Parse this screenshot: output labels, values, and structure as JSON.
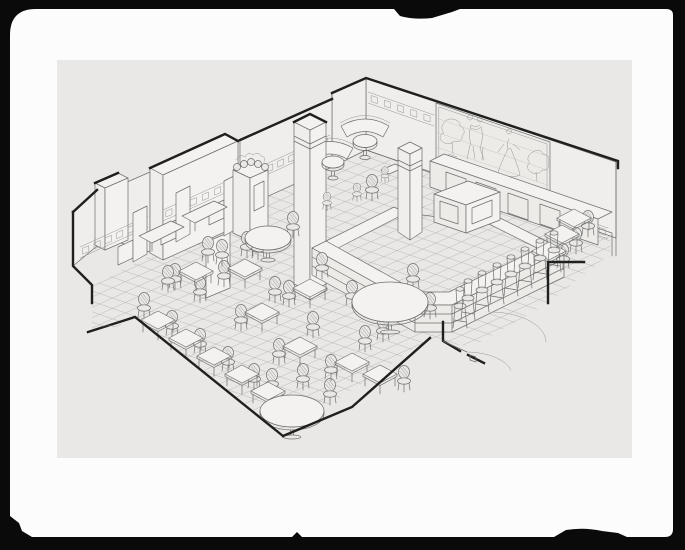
{
  "photo": {
    "frame_color": "#0a0a0a",
    "mat_color": "#fcfcfc",
    "paper_color": "#e9e8e6"
  },
  "colors": {
    "ink": "#6e6e6e",
    "ink_light": "#969593",
    "ink_heavy": "#1f1f1f",
    "fill_white": "#f3f2f0",
    "wall_fill": "#efeeec",
    "panel_fill": "#ecebe8",
    "grid": "#b4b3b0",
    "hatch": "#c6c5c2"
  },
  "drawing": {
    "scene_label": "axonometric cutaway line rendering of a restaurant dining room",
    "features": [
      "stepped-perimeter-walls",
      "ornamental-frieze-band",
      "figural-wall-mural",
      "wall-booths-with-tables",
      "curved-banquettes",
      "china-hutch-with-plates",
      "freestanding-square-column",
      "service-counter-with-pylon",
      "back-bar-cabinets",
      "bar-stool-row",
      "square-dining-tables",
      "bentwood-chairs",
      "tile-floor-grid",
      "door-swing-arcs"
    ],
    "mural_figures": [
      "foliage-left",
      "dancing-couple",
      "gowned-figure",
      "foliage-right"
    ]
  },
  "scene": {
    "grid": {
      "slope_r": 0.345,
      "b_r_min": 20,
      "b_r_max": 320,
      "slope_l": -0.459,
      "b_l_min": 308,
      "b_l_max": 600,
      "step": 10.4
    },
    "frieze_segments": [
      [
        80,
        247,
        148,
        216
      ],
      [
        163,
        210,
        236,
        177
      ],
      [
        242,
        175,
        330,
        135
      ],
      [
        368,
        92,
        434,
        115
      ],
      [
        446,
        172,
        608,
        228
      ]
    ],
    "tables": [
      [
        196,
        271
      ],
      [
        245,
        268
      ],
      [
        310,
        288
      ],
      [
        262,
        312
      ],
      [
        300,
        346
      ],
      [
        352,
        362
      ],
      [
        380,
        374
      ],
      [
        158,
        320
      ],
      [
        186,
        338
      ],
      [
        214,
        356
      ],
      [
        242,
        374
      ],
      [
        268,
        391
      ],
      [
        574,
        218
      ],
      [
        562,
        234
      ],
      [
        549,
        251
      ]
    ],
    "round_tables": [
      [
        390,
        302,
        38,
        20
      ],
      [
        292,
        411,
        32,
        16
      ],
      [
        268,
        238,
        23,
        12
      ],
      [
        365,
        141,
        12,
        6.5
      ],
      [
        333,
        162,
        11,
        6
      ]
    ],
    "chairs": [
      [
        352,
        296
      ],
      [
        413,
        279
      ],
      [
        430,
        308
      ],
      [
        383,
        331
      ],
      [
        272,
        384
      ],
      [
        303,
        379
      ],
      [
        330,
        394
      ],
      [
        247,
        247
      ],
      [
        293,
        227
      ],
      [
        175,
        279
      ],
      [
        208,
        252
      ],
      [
        224,
        276
      ],
      [
        258,
        249
      ],
      [
        289,
        296
      ],
      [
        322,
        268
      ],
      [
        241,
        320
      ],
      [
        275,
        292
      ],
      [
        279,
        354
      ],
      [
        313,
        327
      ],
      [
        331,
        370
      ],
      [
        365,
        341
      ],
      [
        404,
        381
      ],
      [
        144,
        308
      ],
      [
        172,
        326
      ],
      [
        200,
        344
      ],
      [
        228,
        362
      ],
      [
        254,
        379
      ],
      [
        168,
        281
      ],
      [
        200,
        292
      ],
      [
        372,
        190
      ],
      [
        588,
        226
      ],
      [
        576,
        243
      ],
      [
        563,
        259
      ],
      [
        222,
        255
      ],
      [
        357,
        194,
        0.7
      ],
      [
        327,
        203,
        0.7
      ],
      [
        385,
        176,
        0.6
      ]
    ],
    "stools": [
      [
        460,
        306
      ],
      [
        468,
        298
      ],
      [
        482,
        290
      ],
      [
        497,
        282
      ],
      [
        511,
        274
      ],
      [
        525,
        266
      ],
      [
        540,
        258
      ],
      [
        554,
        250
      ]
    ]
  }
}
